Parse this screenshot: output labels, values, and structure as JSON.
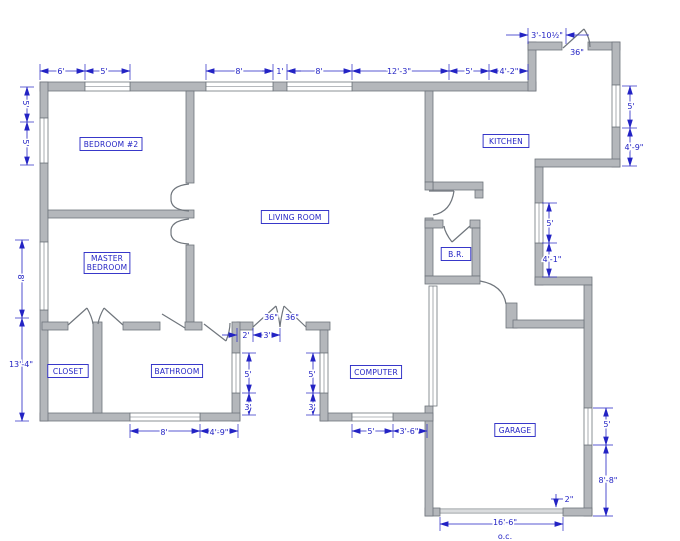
{
  "title": "house floor plan",
  "colors": {
    "wall_fill": "#b4b7bb",
    "wall_edge": "#6f757c",
    "dimension_blue": "#2323c4",
    "background": "#ffffff"
  },
  "rooms": [
    {
      "id": "bedroom-2",
      "label": "BEDROOM #2",
      "x": 111,
      "y": 144
    },
    {
      "id": "master-bedroom",
      "label": "MASTER BEDROOM",
      "lines": [
        "MASTER",
        "BEDROOM"
      ],
      "x": 107,
      "y": 263
    },
    {
      "id": "living-room",
      "label": "LIVING ROOM",
      "x": 295,
      "y": 217
    },
    {
      "id": "kitchen",
      "label": "KITCHEN",
      "x": 506,
      "y": 141
    },
    {
      "id": "br",
      "label": "B.R.",
      "x": 456,
      "y": 254
    },
    {
      "id": "closet",
      "label": "CLOSET",
      "x": 68,
      "y": 371
    },
    {
      "id": "bathroom",
      "label": "BATHROOM",
      "x": 177,
      "y": 371
    },
    {
      "id": "computer",
      "label": "COMPUTER",
      "x": 376,
      "y": 372
    },
    {
      "id": "garage",
      "label": "GARAGE",
      "x": 515,
      "y": 430
    }
  ],
  "door_size_labels": [
    {
      "id": "entry-door-width",
      "label": "36\"",
      "x": 577,
      "y": 52
    },
    {
      "id": "french-door-left-width",
      "label": "36\"",
      "x": 271,
      "y": 317
    },
    {
      "id": "french-door-right-width",
      "label": "36\"",
      "x": 292,
      "y": 317
    }
  ],
  "dimensions": [
    {
      "id": "top-1",
      "label": "6'",
      "x": 61,
      "y": 71
    },
    {
      "id": "top-2",
      "label": "5'",
      "x": 104,
      "y": 71
    },
    {
      "id": "top-3",
      "label": "8'",
      "x": 239,
      "y": 71
    },
    {
      "id": "top-4",
      "label": "1'",
      "x": 280,
      "y": 71
    },
    {
      "id": "top-5",
      "label": "8'",
      "x": 319,
      "y": 71
    },
    {
      "id": "top-6",
      "label": "12'-3\"",
      "x": 399,
      "y": 71
    },
    {
      "id": "top-7",
      "label": "5'",
      "x": 469,
      "y": 71
    },
    {
      "id": "top-8",
      "label": "4'-2\"",
      "x": 509,
      "y": 71
    },
    {
      "id": "top-9",
      "label": "3'-10½\"",
      "x": 547,
      "y": 35
    },
    {
      "id": "left-1",
      "label": "5'",
      "x": 26,
      "y": 104,
      "rot": 90
    },
    {
      "id": "left-2",
      "label": "5'",
      "x": 26,
      "y": 143,
      "rot": 90
    },
    {
      "id": "left-3",
      "label": "8'",
      "x": 21,
      "y": 278,
      "rot": 90
    },
    {
      "id": "left-4",
      "label": "13'-4\"",
      "x": 21,
      "y": 364
    },
    {
      "id": "right-1",
      "label": "5'",
      "x": 631,
      "y": 106
    },
    {
      "id": "right-2",
      "label": "4'-9\"",
      "x": 634,
      "y": 147
    },
    {
      "id": "notch-1",
      "label": "5'",
      "x": 550,
      "y": 223
    },
    {
      "id": "notch-2",
      "label": "4'-1\"",
      "x": 552,
      "y": 259
    },
    {
      "id": "garage-right-1",
      "label": "5'",
      "x": 607,
      "y": 424
    },
    {
      "id": "garage-right-2",
      "label": "8'-8\"",
      "x": 608,
      "y": 480
    },
    {
      "id": "garage-door-thickness",
      "label": "2\"",
      "x": 569,
      "y": 499
    },
    {
      "id": "garage-door-width",
      "label": "16'-6\"",
      "x": 505,
      "y": 522
    },
    {
      "id": "garage-door-oc",
      "label": "o.c.",
      "x": 505,
      "y": 536
    },
    {
      "id": "bottom-1",
      "label": "8'",
      "x": 164,
      "y": 432
    },
    {
      "id": "bottom-2",
      "label": "4'-9\"",
      "x": 219,
      "y": 432
    },
    {
      "id": "bottom-3",
      "label": "5'",
      "x": 371,
      "y": 431
    },
    {
      "id": "bottom-4",
      "label": "3'-6\"",
      "x": 409,
      "y": 431
    },
    {
      "id": "alcove-1",
      "label": "2'",
      "x": 246,
      "y": 335
    },
    {
      "id": "alcove-2",
      "label": "3'",
      "x": 267,
      "y": 335
    },
    {
      "id": "alcove-left-1",
      "label": "5'",
      "x": 248,
      "y": 374
    },
    {
      "id": "alcove-left-2",
      "label": "3'",
      "x": 248,
      "y": 407
    },
    {
      "id": "alcove-right-1",
      "label": "5'",
      "x": 312,
      "y": 374
    },
    {
      "id": "alcove-right-2",
      "label": "3'",
      "x": 312,
      "y": 407
    }
  ]
}
